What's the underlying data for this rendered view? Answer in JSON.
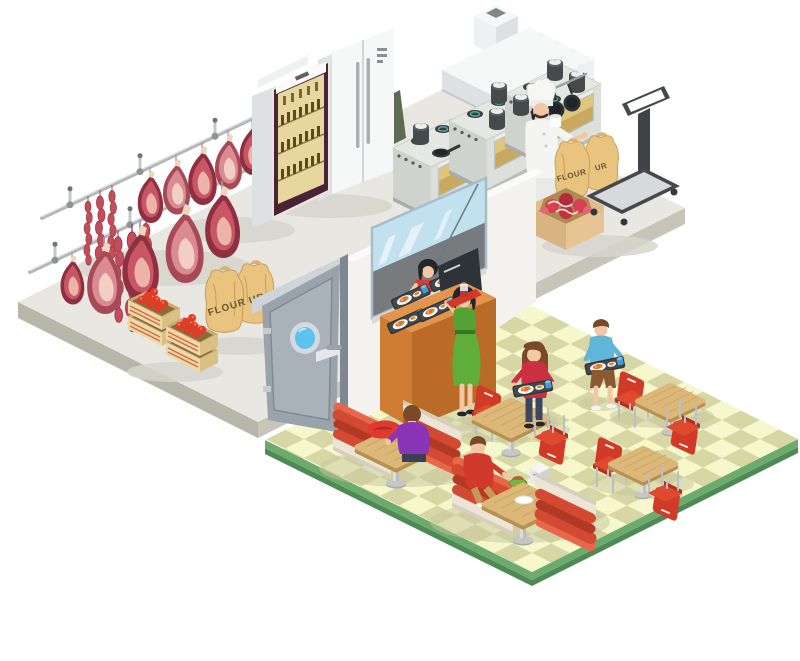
{
  "image": {
    "width": 800,
    "height": 661,
    "background": "#ffffff",
    "description": "Isometric cutaway illustration of a fast-food restaurant: cold storage and butchery with hanging meat, a commercial kitchen, a serving counter and a dining hall with checkered floor."
  },
  "labels": {
    "sack_storage_left": "FLOUR",
    "sack_storage_right": "UR",
    "sack_kitchen_left": "FLOUR",
    "sack_kitchen_right": "UR"
  },
  "palette": {
    "floor_gray": "#e8e7e2",
    "floor_gray_side": "#b6b6a9",
    "floor_check_light": "#f7f7cc",
    "floor_check_dark": "#d7d7a5",
    "floor_edge_green": "#6cab6d",
    "floor_edge_green_dark": "#4e8a54",
    "meat_dark": "#8e3040",
    "meat_mid": "#c95665",
    "meat_pale": "#ecb4a8",
    "booth_red": "#d14a31",
    "chair_red": "#d03a27",
    "table_wood": "#dcb878",
    "counter_orange": "#e2954c",
    "sack_tan": "#e8c47e",
    "door_gray": "#9aa3ab",
    "porthole_blue": "#5bc3ee",
    "window_blue": "#c2e1ef",
    "dress_green": "#5fae3a",
    "apron_red": "#d63b3b",
    "tomato_red": "#e23b27"
  },
  "areas": {
    "storage": {
      "name": "cold-storage-and-butchery",
      "items": [
        "meat-rails",
        "hanging-hams",
        "sausage-links",
        "tomato-crates",
        "flour-sacks",
        "service-door"
      ]
    },
    "kitchen": {
      "name": "commercial-kitchen",
      "items": [
        "beverage-display-cooler",
        "double-door-refrigerator",
        "cooking-range-with-pots",
        "exhaust-hood",
        "pan-rack",
        "chef",
        "flour-sacks",
        "meat-box",
        "platform-scale"
      ]
    },
    "serving": {
      "name": "serving-counter",
      "items": [
        "pass-through-window",
        "server-in-red-apron",
        "food-trays",
        "cash-register",
        "orange-counter",
        "customer-in-green-dress"
      ]
    },
    "dining": {
      "name": "dining-hall",
      "items": [
        "checkered-floor",
        "booth-seats",
        "pedestal-tables",
        "red-chairs",
        "seated-customer-purple-shirt",
        "seated-customer-red-shirt",
        "customer-with-tray-red-sweater",
        "customer-with-tray-blue-shirt",
        "napkin-dispenser"
      ]
    }
  }
}
